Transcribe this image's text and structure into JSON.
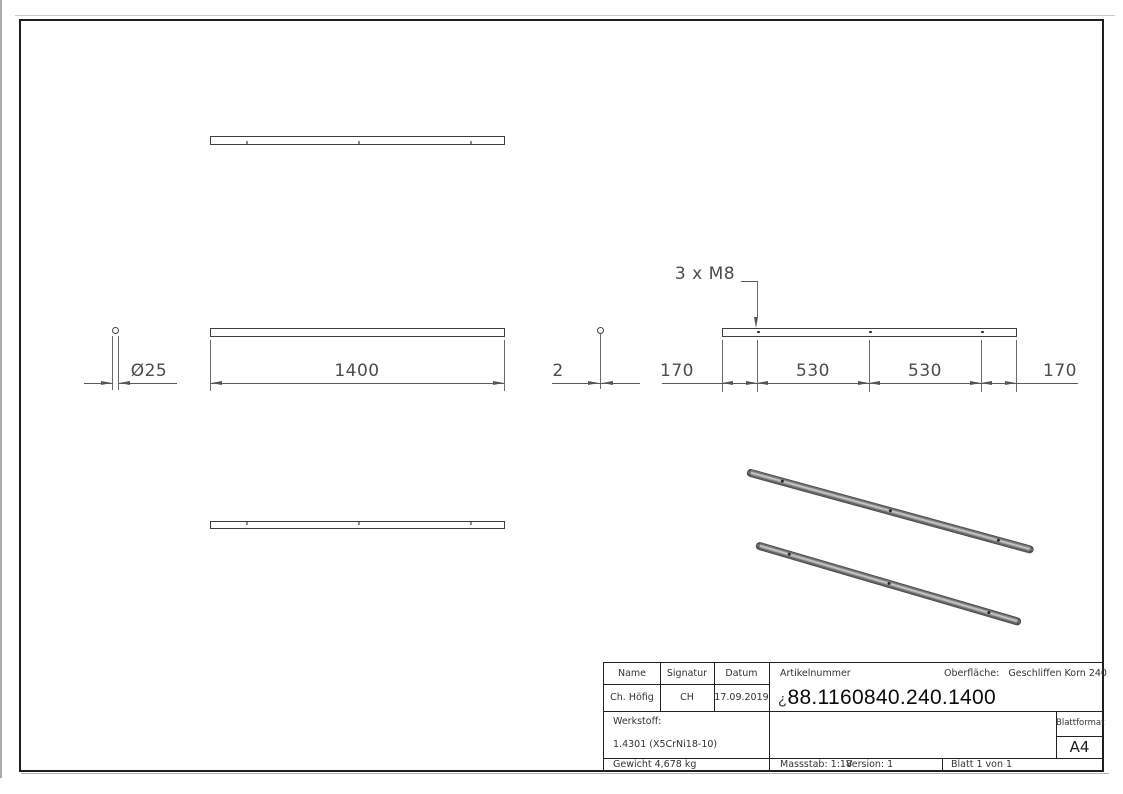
{
  "drawing": {
    "dims": {
      "length": "1400",
      "diameter": "Ø25",
      "thickness": "2",
      "holes_note": "3 x M8",
      "chain": [
        "170",
        "530",
        "530",
        "170"
      ]
    },
    "title_block": {
      "name_label": "Name",
      "signatur_label": "Signatur",
      "datum_label": "Datum",
      "name_value": "Ch. Höfig",
      "signatur_value": "CH",
      "datum_value": "17.09.2019",
      "artikelnummer_label": "Artikelnummer",
      "artikelnummer_prefix": "¿",
      "artikelnummer_value": "88.1160840.240.1400",
      "oberflaeche_label": "Oberfläche:",
      "oberflaeche_value": "Geschliffen Korn 240",
      "werkstoff_label": "Werkstoff:",
      "werkstoff_value": "1.4301 (X5CrNi18-10)",
      "gewicht_value": "Gewicht 4,678 kg",
      "massstab_value": "Massstab: 1:18",
      "version_value": "Version: 1",
      "blatt_value": "Blatt 1 von 1",
      "blattformat_label": "Blattformat",
      "blattformat_value": "A4"
    },
    "colors": {
      "line": "#555555",
      "edge": "#3d3d3d",
      "text": "#4c4c4c"
    }
  }
}
